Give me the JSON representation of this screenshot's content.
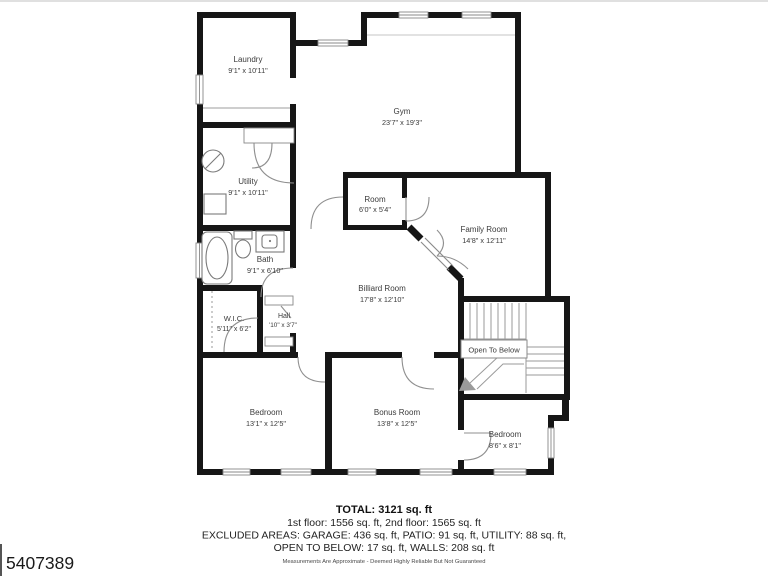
{
  "plan": {
    "rooms": {
      "laundry": {
        "name": "Laundry",
        "dims": "9'1\" x 10'11\""
      },
      "gym": {
        "name": "Gym",
        "dims": "23'7\" x 19'3\""
      },
      "utility": {
        "name": "Utility",
        "dims": "9'1\" x 10'11\""
      },
      "room": {
        "name": "Room",
        "dims": "6'0\" x 5'4\""
      },
      "family_room": {
        "name": "Family Room",
        "dims": "14'8\" x 12'11\""
      },
      "bath": {
        "name": "Bath",
        "dims": "9'1\" x 6'10\""
      },
      "billiard_room": {
        "name": "Billiard Room",
        "dims": "17'8\" x 12'10\""
      },
      "wic": {
        "name": "W.I.C.",
        "dims": "5'11\" x 6'2\""
      },
      "hall": {
        "name": "Hall",
        "dims": "'10\" x 3'7\""
      },
      "bedroom_left": {
        "name": "Bedroom",
        "dims": "13'1\" x 12'5\""
      },
      "bonus_room": {
        "name": "Bonus Room",
        "dims": "13'8\" x 12'5\""
      },
      "bedroom_right": {
        "name": "Bedroom",
        "dims": "8'6\" x 8'1\""
      }
    },
    "stairs": {
      "label": "Open To Below"
    }
  },
  "summary": {
    "total": "TOTAL: 3121 sq. ft",
    "floors": "1st floor: 1556 sq. ft, 2nd floor: 1565 sq. ft",
    "excluded_line1": "EXCLUDED AREAS: GARAGE: 436 sq. ft, PATIO: 91 sq. ft, UTILITY: 88 sq. ft,",
    "excluded_line2": "OPEN TO BELOW: 17 sq. ft, WALLS: 208 sq. ft",
    "disclaimer": "Measurements Are Approximate - Deemed Highly Reliable But Not Guaranteed"
  },
  "mls_number": "5407389",
  "colors": {
    "wall": "#161616",
    "line": "#8a8a8a",
    "text": "#3b3b3b"
  }
}
